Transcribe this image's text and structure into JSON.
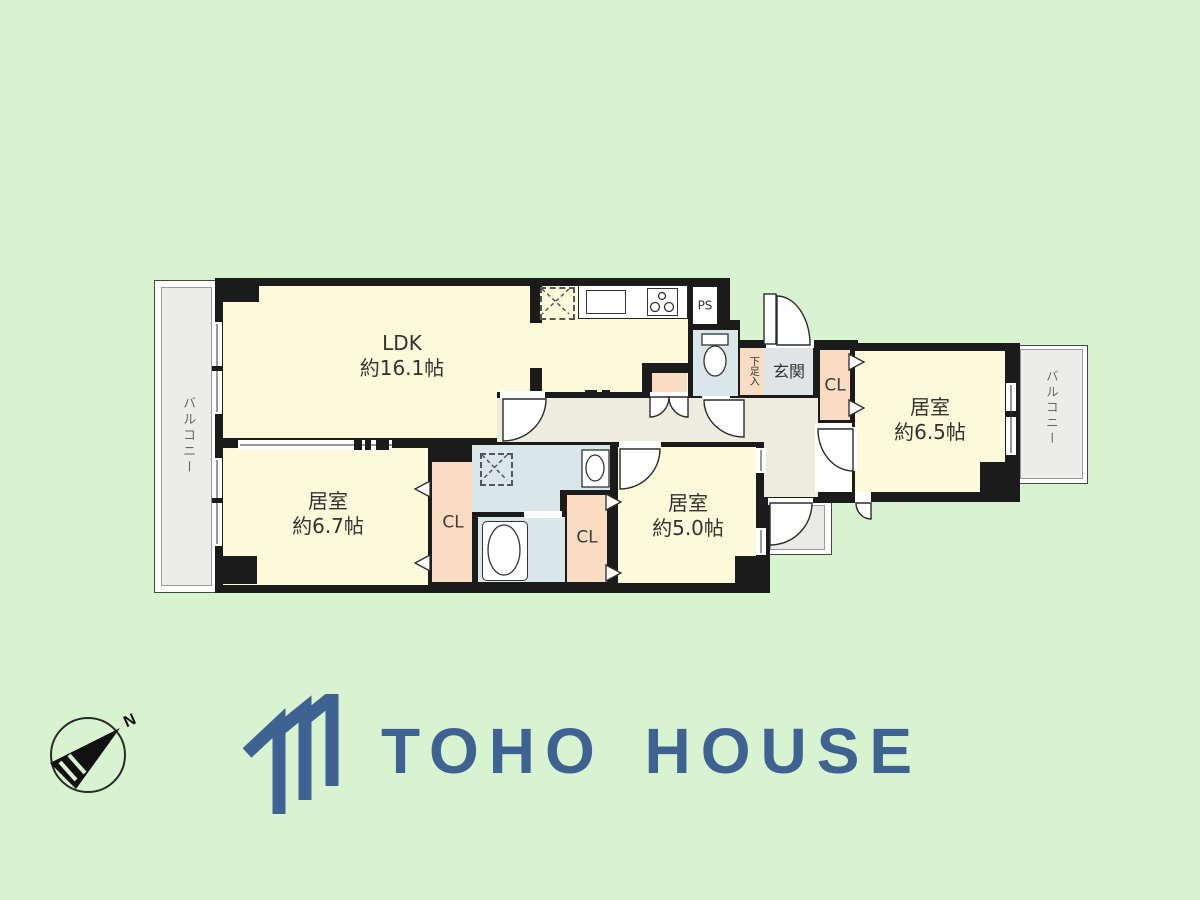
{
  "colors": {
    "background": "#d8f3d0",
    "wall": "#1b1b1b",
    "room_cream": "#fdfadc",
    "closet_peach": "#f9dcc2",
    "wet_area_blue": "#d9e7ea",
    "hallway_beige": "#edecdf",
    "entrance_gray": "#e0e4e6",
    "balcony_gray": "#ececea",
    "logo_blue": "#3e6292"
  },
  "plan": {
    "rooms": [
      {
        "name": "LDK",
        "size": "約16.1帖"
      },
      {
        "name": "居室",
        "size": "約6.7帖"
      },
      {
        "name": "居室",
        "size": "約5.0帖"
      },
      {
        "name": "居室",
        "size": "約6.5帖"
      }
    ],
    "labels": {
      "closet": "CL",
      "entrance": "玄関",
      "shoe_cabinet": "下足入",
      "pipe_space": "PS",
      "balcony": "バルコニー"
    }
  },
  "compass": {
    "north": "N"
  },
  "logo": {
    "name": "TOHO HOUSE"
  }
}
